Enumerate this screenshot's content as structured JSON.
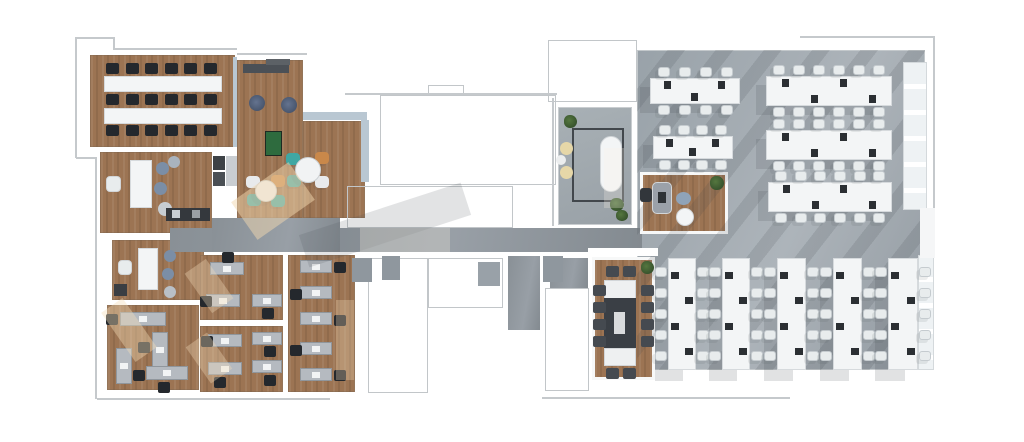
{
  "canvas": {
    "width": 1024,
    "height": 442,
    "background": "#ffffff"
  },
  "palette": {
    "wood": "#9c7453",
    "grayFloor": "#99a2a9",
    "corridor": "#899096",
    "wall": "#ffffff",
    "line": "#c5c9cc",
    "window": "#b9c7d2",
    "deskW": "#f3f5f6",
    "deskG": "#b5bac0",
    "chairW": "#e8eced",
    "chairB": "#24282d",
    "chairD": "#454a50",
    "tableD": "#3a3f45",
    "pouf": "#55647a",
    "stool": "#7b8ea6",
    "foos": "#2e6b3e",
    "tan": "#e6d7a8",
    "teal": "#3fa7a3",
    "orange": "#c9884a",
    "plant": "#3c5a35"
  },
  "floors": [
    {
      "n": "training-room-floor",
      "x": 90,
      "y": 55,
      "w": 145,
      "h": 92,
      "f": "wood"
    },
    {
      "n": "lounge-floor-left",
      "x": 237,
      "y": 60,
      "w": 66,
      "h": 158,
      "f": "wood"
    },
    {
      "n": "lounge-floor-right",
      "x": 303,
      "y": 121,
      "w": 62,
      "h": 97,
      "f": "wood"
    },
    {
      "n": "kitchen-floor",
      "x": 100,
      "y": 152,
      "w": 112,
      "h": 81,
      "f": "wood"
    },
    {
      "n": "huddle-room-floor",
      "x": 112,
      "y": 240,
      "w": 92,
      "h": 60,
      "f": "wood"
    },
    {
      "n": "office-sw-floor",
      "x": 107,
      "y": 305,
      "w": 92,
      "h": 85,
      "f": "wood"
    },
    {
      "n": "office-s1-floor",
      "x": 200,
      "y": 255,
      "w": 83,
      "h": 65,
      "f": "wood"
    },
    {
      "n": "office-s2-floor",
      "x": 200,
      "y": 326,
      "w": 83,
      "h": 66,
      "f": "wood"
    },
    {
      "n": "office-s3-floor",
      "x": 288,
      "y": 255,
      "w": 67,
      "h": 137,
      "f": "wood"
    },
    {
      "n": "open-office-floor",
      "x": 637,
      "y": 50,
      "w": 288,
      "h": 320,
      "f": "gray"
    },
    {
      "n": "meeting-room-floor",
      "x": 558,
      "y": 107,
      "w": 74,
      "h": 118,
      "f": "graylight"
    },
    {
      "n": "corridor-floor",
      "x": 170,
      "y": 228,
      "w": 472,
      "h": 24,
      "f": "corridor"
    },
    {
      "n": "corridor-floor-upper",
      "x": 212,
      "y": 218,
      "w": 128,
      "h": 34,
      "f": "corridor"
    },
    {
      "n": "core-gray-strip",
      "x": 508,
      "y": 256,
      "w": 32,
      "h": 74,
      "f": "corridor"
    },
    {
      "n": "core-gray-patch",
      "x": 550,
      "y": 258,
      "w": 38,
      "h": 30,
      "f": "corridor"
    },
    {
      "n": "lounge-corner-floor",
      "x": 640,
      "y": 172,
      "w": 88,
      "h": 62,
      "f": "wood",
      "wb": 1
    },
    {
      "n": "conference-room-floor",
      "x": 592,
      "y": 257,
      "w": 63,
      "h": 123,
      "f": "wood",
      "wb": 1
    }
  ],
  "outlines": [
    {
      "x": 380,
      "y": 95,
      "w": 176,
      "h": 90
    },
    {
      "x": 347,
      "y": 186,
      "w": 166,
      "h": 42
    },
    {
      "x": 368,
      "y": 258,
      "w": 60,
      "h": 135
    },
    {
      "x": 428,
      "y": 258,
      "w": 75,
      "h": 50
    },
    {
      "x": 545,
      "y": 288,
      "w": 44,
      "h": 103
    },
    {
      "x": 548,
      "y": 40,
      "w": 89,
      "h": 62
    },
    {
      "x": 428,
      "y": 85,
      "w": 36,
      "h": 10
    }
  ],
  "lines": [
    {
      "x": 75,
      "y": 37,
      "w": 1.5,
      "h": 121
    },
    {
      "x": 75,
      "y": 37,
      "w": 39,
      "h": 1.5
    },
    {
      "x": 113,
      "y": 37,
      "w": 1.5,
      "h": 12
    },
    {
      "x": 113,
      "y": 48,
      "w": 124,
      "h": 1.5
    },
    {
      "x": 95,
      "y": 157,
      "w": 1.5,
      "h": 242
    },
    {
      "x": 76,
      "y": 157,
      "w": 20,
      "h": 1.5
    },
    {
      "x": 97,
      "y": 398,
      "w": 233,
      "h": 1.5
    },
    {
      "x": 542,
      "y": 397,
      "w": 248,
      "h": 1.5
    },
    {
      "x": 345,
      "y": 93,
      "w": 212,
      "h": 1.5
    },
    {
      "x": 552,
      "y": 98,
      "w": 1.5,
      "h": 128
    },
    {
      "x": 800,
      "y": 36,
      "w": 134,
      "h": 1.5
    },
    {
      "x": 933,
      "y": 36,
      "w": 1.5,
      "h": 22
    },
    {
      "x": 933,
      "y": 55,
      "w": 1.5,
      "h": 155
    },
    {
      "x": 237,
      "y": 53,
      "w": 70,
      "h": 1.5
    }
  ],
  "items": [
    {
      "n": "shadow-stripes",
      "x": 637,
      "y": 50,
      "w": 288,
      "h": 320,
      "cls": "stripes"
    },
    {
      "n": "window-band",
      "x": 303,
      "y": 112,
      "w": 64,
      "h": 8,
      "f": "window"
    },
    {
      "n": "window-band",
      "x": 361,
      "y": 120,
      "w": 8,
      "h": 62,
      "f": "window"
    },
    {
      "n": "window-band",
      "x": 233,
      "y": 57,
      "w": 4,
      "h": 90,
      "f": "window"
    },
    {
      "n": "window-panel",
      "x": 903,
      "y": 62,
      "w": 24,
      "h": 148,
      "cls": "panel"
    },
    {
      "n": "window-panel",
      "x": 918,
      "y": 255,
      "w": 16,
      "h": 115,
      "cls": "panel"
    },
    {
      "n": "wall-band",
      "x": 920,
      "y": 208,
      "w": 15,
      "h": 50,
      "f": "#f5f6f7"
    },
    {
      "n": "wall",
      "x": 588,
      "y": 248,
      "w": 70,
      "h": 8,
      "f": "#ffffff"
    },
    {
      "n": "training-desk-row",
      "x": 104,
      "y": 76,
      "w": 118,
      "h": 16,
      "cls": "deskw"
    },
    {
      "n": "training-desk-row",
      "x": 104,
      "y": 108,
      "w": 118,
      "h": 16,
      "cls": "deskw"
    },
    {
      "n": "media-cabinet",
      "x": 243,
      "y": 64,
      "w": 46,
      "h": 9,
      "f": "#4b5056"
    },
    {
      "n": "media-cabinet",
      "x": 266,
      "y": 59,
      "w": 24,
      "h": 6,
      "f": "#5c6166"
    },
    {
      "n": "lounge-pouf",
      "x": 249,
      "y": 95,
      "w": 16,
      "h": 16,
      "cls": "pouf-dark"
    },
    {
      "n": "lounge-pouf",
      "x": 281,
      "y": 97,
      "w": 16,
      "h": 16,
      "cls": "pouf-dark"
    },
    {
      "n": "foosball-table",
      "x": 265,
      "y": 131,
      "w": 17,
      "h": 25,
      "f": "foos",
      "bd": 1,
      "bc": "#1d2a22"
    },
    {
      "n": "kitchen-table",
      "x": 130,
      "y": 160,
      "w": 22,
      "h": 48,
      "cls": "deskw"
    },
    {
      "n": "kitchen-chair",
      "x": 106,
      "y": 176,
      "w": 15,
      "h": 16,
      "f": "chairW",
      "rad": 4,
      "bd": 1
    },
    {
      "n": "stool",
      "x": 156,
      "y": 162,
      "w": 13,
      "h": 13,
      "f": "stool",
      "s": "c"
    },
    {
      "n": "stool",
      "x": 154,
      "y": 182,
      "w": 13,
      "h": 13,
      "f": "stool",
      "s": "c"
    },
    {
      "n": "stool",
      "x": 158,
      "y": 202,
      "w": 14,
      "h": 14,
      "f": "#c7cdd2",
      "s": "c"
    },
    {
      "n": "stool",
      "x": 168,
      "y": 156,
      "w": 12,
      "h": 12,
      "f": "#a9b3be",
      "s": "c"
    },
    {
      "n": "kitchen-counter",
      "x": 166,
      "y": 208,
      "w": 44,
      "h": 13,
      "f": "#34383d"
    },
    {
      "n": "appliance",
      "x": 172,
      "y": 210,
      "w": 8,
      "h": 8,
      "f": "#c9ced2"
    },
    {
      "n": "appliance",
      "x": 192,
      "y": 210,
      "w": 8,
      "h": 8,
      "f": "#9aa0a5"
    },
    {
      "n": "cabinet",
      "x": 213,
      "y": 156,
      "w": 12,
      "h": 14,
      "f": "#3e4246"
    },
    {
      "n": "cabinet",
      "x": 213,
      "y": 172,
      "w": 12,
      "h": 14,
      "f": "#4a4f54"
    },
    {
      "n": "cabinet",
      "x": 226,
      "y": 156,
      "w": 11,
      "h": 30,
      "f": "#c9cdd1"
    },
    {
      "n": "huddle-table",
      "x": 138,
      "y": 248,
      "w": 20,
      "h": 42,
      "cls": "deskw"
    },
    {
      "n": "huddle-chair",
      "x": 118,
      "y": 260,
      "w": 14,
      "h": 15,
      "f": "chairW",
      "rad": 4,
      "bd": 1
    },
    {
      "n": "stool",
      "x": 164,
      "y": 250,
      "w": 12,
      "h": 12,
      "f": "stool",
      "s": "c"
    },
    {
      "n": "stool",
      "x": 162,
      "y": 268,
      "w": 12,
      "h": 12,
      "f": "stool",
      "s": "c"
    },
    {
      "n": "stool",
      "x": 164,
      "y": 286,
      "w": 12,
      "h": 12,
      "f": "#b9c0c7",
      "s": "c"
    },
    {
      "n": "cabinet",
      "x": 114,
      "y": 284,
      "w": 13,
      "h": 12,
      "f": "#3a3e43"
    },
    {
      "n": "rug-outline",
      "x": 572,
      "y": 128,
      "w": 52,
      "h": 74,
      "cls": "rug"
    },
    {
      "n": "oval-table",
      "x": 600,
      "y": 136,
      "w": 22,
      "h": 56,
      "f": "deskW",
      "rad": 11,
      "bd": 1
    },
    {
      "n": "pouf",
      "x": 560,
      "y": 142,
      "w": 13,
      "h": 13,
      "f": "tan",
      "s": "c"
    },
    {
      "n": "pouf",
      "x": 560,
      "y": 166,
      "w": 13,
      "h": 13,
      "f": "tan",
      "s": "c"
    },
    {
      "n": "pouf",
      "x": 556,
      "y": 155,
      "w": 10,
      "h": 10,
      "f": "#eceeef",
      "s": "c"
    },
    {
      "n": "plant",
      "x": 564,
      "y": 115,
      "w": 13,
      "h": 13,
      "cls": "plant"
    },
    {
      "n": "plant",
      "x": 610,
      "y": 198,
      "w": 14,
      "h": 13,
      "cls": "plant"
    },
    {
      "n": "plant",
      "x": 616,
      "y": 210,
      "w": 12,
      "h": 11,
      "cls": "plant"
    },
    {
      "n": "lounge-chair",
      "x": 652,
      "y": 182,
      "w": 20,
      "h": 32,
      "f": "#9ba1a9",
      "rad": 5,
      "bd": 1
    },
    {
      "n": "side-chair",
      "x": 640,
      "y": 188,
      "w": 12,
      "h": 14,
      "f": "#32363b",
      "rad": 3
    },
    {
      "n": "phone-mark",
      "x": 658,
      "y": 192,
      "w": 8,
      "h": 11,
      "f": "#2e3236"
    },
    {
      "n": "pouf",
      "x": 676,
      "y": 192,
      "w": 15,
      "h": 13,
      "f": "#8fa3b8",
      "s": "c"
    },
    {
      "n": "coffee-table",
      "x": 676,
      "y": 208,
      "w": 18,
      "h": 18,
      "f": "deskW",
      "s": "c",
      "bd": 1
    },
    {
      "n": "plant",
      "x": 710,
      "y": 176,
      "w": 14,
      "h": 14,
      "cls": "plant"
    },
    {
      "n": "conference-table-end",
      "x": 604,
      "y": 280,
      "w": 32,
      "h": 20,
      "f": "#eef0f1",
      "bd": 1
    },
    {
      "n": "conference-table",
      "x": 604,
      "y": 298,
      "w": 32,
      "h": 52,
      "f": "tableD"
    },
    {
      "n": "conference-table-end",
      "x": 604,
      "y": 348,
      "w": 32,
      "h": 18,
      "f": "#eef0f1",
      "bd": 1
    },
    {
      "n": "laptop",
      "x": 614,
      "y": 312,
      "w": 11,
      "h": 22,
      "f": "#d9dbdd"
    },
    {
      "n": "plant",
      "x": 641,
      "y": 261,
      "w": 13,
      "h": 13,
      "cls": "plant"
    },
    {
      "n": "office-chair-dark",
      "x": 672,
      "y": 339,
      "w": 12,
      "h": 11,
      "f": "#2f3338",
      "rad": 3
    },
    {
      "n": "office-chair-dark",
      "x": 726,
      "y": 339,
      "w": 12,
      "h": 11,
      "f": "#2f3338",
      "rad": 3
    },
    {
      "n": "office-chair-dark",
      "x": 781,
      "y": 339,
      "w": 12,
      "h": 11,
      "f": "#2f3338",
      "rad": 3
    },
    {
      "n": "office-chair-dark",
      "x": 837,
      "y": 339,
      "w": 12,
      "h": 11,
      "f": "#2f3338",
      "rad": 3
    },
    {
      "n": "office-chair-dark",
      "x": 892,
      "y": 339,
      "w": 12,
      "h": 11,
      "f": "#2f3338",
      "rad": 3
    },
    {
      "n": "shaft",
      "x": 352,
      "y": 258,
      "w": 20,
      "h": 24,
      "f": "#8f979e"
    },
    {
      "n": "shaft",
      "x": 382,
      "y": 256,
      "w": 18,
      "h": 24,
      "f": "#8f979e"
    },
    {
      "n": "shaft",
      "x": 478,
      "y": 262,
      "w": 22,
      "h": 24,
      "f": "#99a1a8"
    },
    {
      "n": "shaft",
      "x": 543,
      "y": 256,
      "w": 20,
      "h": 26,
      "f": "#8f979e"
    }
  ],
  "benches": [
    {
      "x": 650,
      "y": 78,
      "w": 90,
      "h": 26,
      "dir": "h",
      "seats": 4,
      "mon": 3
    },
    {
      "x": 653,
      "y": 136,
      "w": 80,
      "h": 23,
      "dir": "h",
      "seats": 4,
      "mon": 3
    },
    {
      "x": 766,
      "y": 76,
      "w": 126,
      "h": 30,
      "dir": "h",
      "seats": 6,
      "mon": 4
    },
    {
      "x": 766,
      "y": 130,
      "w": 126,
      "h": 30,
      "dir": "h",
      "seats": 6,
      "mon": 4
    },
    {
      "x": 768,
      "y": 182,
      "w": 124,
      "h": 30,
      "dir": "h",
      "seats": 6,
      "mon": 4
    },
    {
      "x": 668,
      "y": 258,
      "w": 28,
      "h": 112,
      "dir": "v",
      "seats": 5,
      "mon": 4
    },
    {
      "x": 722,
      "y": 258,
      "w": 28,
      "h": 112,
      "dir": "v",
      "seats": 5,
      "mon": 4
    },
    {
      "x": 777,
      "y": 258,
      "w": 29,
      "h": 112,
      "dir": "v",
      "seats": 5,
      "mon": 4
    },
    {
      "x": 833,
      "y": 258,
      "w": 29,
      "h": 112,
      "dir": "v",
      "seats": 5,
      "mon": 4
    },
    {
      "x": 888,
      "y": 258,
      "w": 30,
      "h": 112,
      "dir": "v",
      "seats": 5,
      "mon": 4
    }
  ],
  "desks": [
    {
      "x": 120,
      "y": 312,
      "w": 46,
      "h": 14,
      "cx": 106,
      "cy": 314
    },
    {
      "x": 152,
      "y": 332,
      "w": 16,
      "h": 36,
      "cx": 138,
      "cy": 342
    },
    {
      "x": 116,
      "y": 348,
      "w": 16,
      "h": 36,
      "cx": 133,
      "cy": 370
    },
    {
      "x": 146,
      "y": 366,
      "w": 42,
      "h": 14,
      "cx": 158,
      "cy": 382
    },
    {
      "x": 210,
      "y": 262,
      "w": 34,
      "h": 13,
      "cx": 222,
      "cy": 252
    },
    {
      "x": 206,
      "y": 294,
      "w": 34,
      "h": 13,
      "cx": 200,
      "cy": 296
    },
    {
      "x": 252,
      "y": 294,
      "w": 30,
      "h": 13,
      "cx": 262,
      "cy": 308
    },
    {
      "x": 208,
      "y": 334,
      "w": 34,
      "h": 13,
      "cx": 201,
      "cy": 336
    },
    {
      "x": 208,
      "y": 362,
      "w": 34,
      "h": 13,
      "cx": 214,
      "cy": 377
    },
    {
      "x": 252,
      "y": 332,
      "w": 30,
      "h": 13,
      "cx": 264,
      "cy": 346
    },
    {
      "x": 252,
      "y": 360,
      "w": 30,
      "h": 13,
      "cx": 264,
      "cy": 375
    },
    {
      "x": 300,
      "y": 260,
      "w": 32,
      "h": 13,
      "cx": 334,
      "cy": 262
    },
    {
      "x": 300,
      "y": 286,
      "w": 32,
      "h": 13,
      "cx": 290,
      "cy": 289
    },
    {
      "x": 300,
      "y": 312,
      "w": 32,
      "h": 13,
      "cx": 334,
      "cy": 315
    },
    {
      "x": 300,
      "y": 342,
      "w": 32,
      "h": 13,
      "cx": 290,
      "cy": 345
    },
    {
      "x": 300,
      "y": 368,
      "w": 32,
      "h": 13,
      "cx": 334,
      "cy": 370
    }
  ],
  "chairRows": [
    {
      "x": 106,
      "y": 63,
      "n": 6,
      "gap": 19.5,
      "c": "chairB"
    },
    {
      "x": 106,
      "y": 94,
      "n": 6,
      "gap": 19.5,
      "c": "chairB"
    },
    {
      "x": 106,
      "y": 125,
      "n": 6,
      "gap": 19.5,
      "c": "chairB"
    },
    {
      "x": 606,
      "y": 266,
      "n": 2,
      "gap": 17,
      "c": "chairD"
    },
    {
      "x": 606,
      "y": 368,
      "n": 2,
      "gap": 17,
      "c": "chairD"
    }
  ],
  "chairCols": [
    {
      "x": 593,
      "y": 285,
      "n": 4,
      "gap": 17,
      "c": "chairD"
    },
    {
      "x": 641,
      "y": 285,
      "n": 4,
      "gap": 17,
      "c": "chairD"
    }
  ],
  "tables": [
    {
      "cx": 308,
      "cy": 170,
      "r": 13,
      "chairs": [
        {
          "dx": -15,
          "dy": -11,
          "c": "teal"
        },
        {
          "dx": 14,
          "dy": -12,
          "c": "orange"
        },
        {
          "dx": -14,
          "dy": 11,
          "c": "teal"
        },
        {
          "dx": 14,
          "dy": 12,
          "c": "#e8eaec"
        }
      ]
    },
    {
      "cx": 266,
      "cy": 191,
      "r": 11,
      "chairs": [
        {
          "dx": -13,
          "dy": -9,
          "c": "#e8eaec"
        },
        {
          "dx": 12,
          "dy": -10,
          "c": "orange"
        },
        {
          "dx": -12,
          "dy": 9,
          "c": "teal"
        },
        {
          "dx": 12,
          "dy": 10,
          "c": "teal"
        }
      ]
    }
  ],
  "overlays": [
    {
      "n": "shadow",
      "x": 300,
      "y": 208,
      "w": 170,
      "h": 34,
      "f": "rgba(73,79,85,0.16)",
      "rot": -18
    },
    {
      "n": "sunlight",
      "x": 238,
      "y": 178,
      "w": 70,
      "h": 46,
      "f": "rgba(242,216,176,0.5)",
      "rot": -35
    },
    {
      "n": "sunlight",
      "x": 360,
      "y": 228,
      "w": 90,
      "h": 24,
      "f": "rgba(248,240,226,0.28)",
      "rot": 0
    },
    {
      "n": "sunlight",
      "x": 116,
      "y": 300,
      "w": 26,
      "h": 60,
      "f": "rgba(244,222,185,0.4)",
      "rot": -35
    },
    {
      "n": "sunlight",
      "x": 196,
      "y": 262,
      "w": 26,
      "h": 48,
      "f": "rgba(244,222,185,0.35)",
      "rot": -35
    },
    {
      "n": "sunlight",
      "x": 196,
      "y": 336,
      "w": 26,
      "h": 44,
      "f": "rgba(244,222,185,0.35)",
      "rot": -35
    },
    {
      "n": "sunlight",
      "x": 336,
      "y": 300,
      "w": 18,
      "h": 80,
      "f": "rgba(244,222,185,0.3)",
      "rot": 0
    },
    {
      "n": "sunlight",
      "x": 604,
      "y": 148,
      "w": 20,
      "h": 60,
      "f": "rgba(250,244,232,0.25)",
      "rot": 0
    }
  ]
}
